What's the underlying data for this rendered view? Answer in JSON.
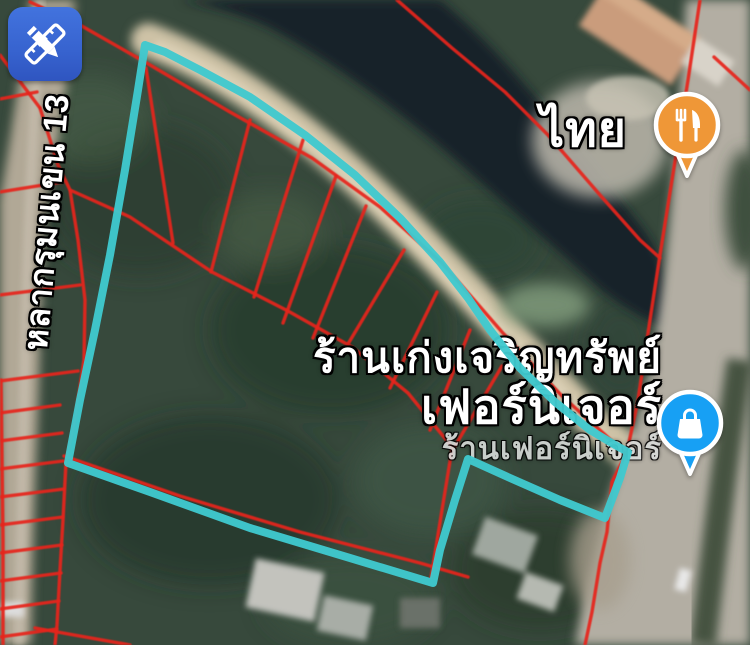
{
  "map": {
    "type": "satellite-annotated",
    "poi": {
      "thai_label": "ไทย",
      "store_name_line1": "ร้านเก่งเจริญทรัพย์",
      "store_name_line2": "เฟอร์นิเจอร์",
      "store_name_line3": "ร้านเฟอร์นิเจอร์",
      "road_label": "หลากรุมนเขน 13"
    },
    "pins": [
      {
        "name": "restaurant-pin",
        "color": "#ef9737",
        "icon": "fork-knife-icon"
      },
      {
        "name": "shopping-pin",
        "color": "#17a0f4",
        "icon": "shopping-bag-icon"
      }
    ],
    "badge": {
      "name": "draw-edit-badge",
      "color": "#3c6bd9",
      "icon": "pencil-ruler-icon"
    },
    "colors": {
      "highlight_boundary": "#3fc9ce",
      "parcel_lines": "#e6251c",
      "water": "#18222b",
      "canal_path": "#cfc2a4",
      "road": "#b3aea2",
      "vegetation": "#36493b"
    }
  },
  "overlay": {
    "highlight_polygon": "145,45 165,52 200,70 250,97 305,135 355,175 400,218 440,262 468,298 490,330 520,368 555,402 590,430 615,445 628,452 620,478 605,518 560,500 510,478 468,459 455,500 440,550 433,583 350,558 250,528 150,492 68,463 80,400 95,330 110,255 125,170 138,90 145,45",
    "parcel_lines": [
      "30,2 80,25 145,62 230,112 312,158 380,207 442,263 502,332 562,396 612,441 626,454",
      "70,190 130,217 212,272 288,311 352,347 408,393 452,447",
      "146,68 173,243",
      "250,120 211,272",
      "303,140 254,297",
      "336,176 283,323",
      "366,206 313,338",
      "404,250 348,344",
      "437,292 390,388",
      "470,330 430,430",
      "502,366 455,446",
      "452,449 442,510 431,578",
      "64,456 180,496 300,532 420,563 468,577",
      "700,0 688,80 672,180 660,255 650,320 638,400 627,452 612,482 607,532 600,563 592,612 585,645",
      "714,57 750,90",
      "397,0 452,48 505,92 548,135 600,195 640,240 660,258",
      "40,108 58,165 70,190 78,240 85,300 84,360 75,420 66,462 63,520 60,570 57,625 55,645",
      "0,55 40,108",
      "1,380 2,460 3,540 3,645",
      "0,99 37,92",
      "0,192 62,182",
      "0,295 80,285",
      "0,381 78,371",
      "0,413 60,405",
      "0,441 62,433",
      "0,469 63,461",
      "0,497 64,489",
      "0,525 63,517",
      "0,553 62,545",
      "0,581 61,573",
      "0,609 59,601",
      "0,637 57,629",
      "35,628 130,645"
    ]
  }
}
